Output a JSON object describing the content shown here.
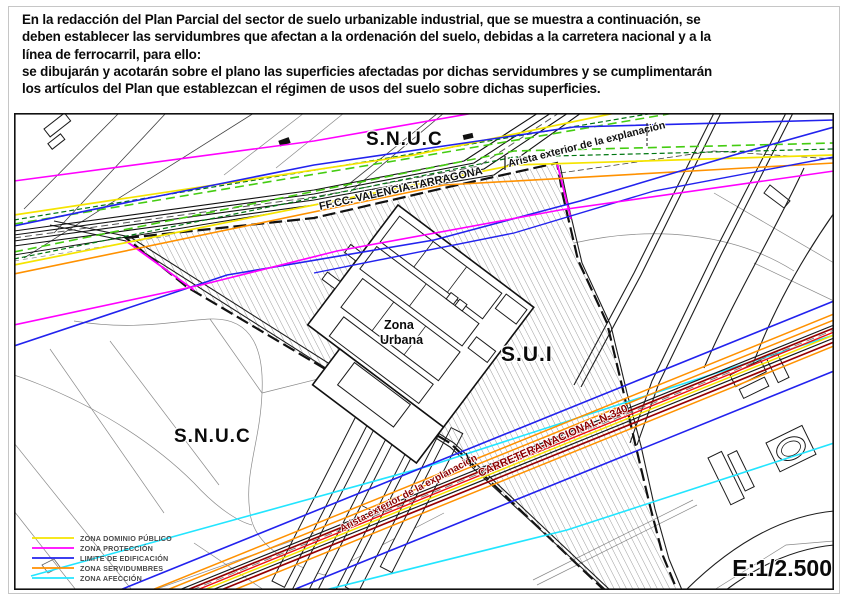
{
  "header": {
    "lines": [
      "En la redacción del Plan Parcial del sector de suelo urbanizable industrial, que se muestra a continuación, se",
      "deben establecer las servidumbres que afectan a la ordenación del suelo, debidas a la carretera nacional y a la",
      "línea de ferrocarril, para ello:",
      "se dibujarán y acotarán sobre el plano las superficies afectadas por dichas servidumbres y se cumplimentarán",
      "los artículos del Plan que establezcan el régimen de usos del suelo sobre dichas superficies."
    ]
  },
  "map": {
    "labels": {
      "snuc_top": "S.N.U.C",
      "snuc_bottom": "S.N.U.C",
      "sui": "S.U.I",
      "zona_urbana_1": "Zona",
      "zona_urbana_2": "Urbana",
      "railway_name": "FF.CC. VALENCIA-TARRAGONA",
      "railway_edge": "Arista exterior de la explanación",
      "road_edge": "Arista exterior de la explanación",
      "road_name": "CARRETERA NACIONAL N-340"
    },
    "scale": "E:1/2.500",
    "legend": {
      "items": [
        {
          "label": "ZONA DOMINIO PÚBLICO",
          "color": "#f5e400"
        },
        {
          "label": "ZONA PROTECCIÓN",
          "color": "#ff00ff"
        },
        {
          "label": "LIMITE DE EDIFICACIÓN",
          "color": "#2222ee"
        },
        {
          "label": "ZONA SERVIDUMBRES",
          "color": "#ff9100"
        },
        {
          "label": "ZONA AFECCIÓN",
          "color": "#22e5ff"
        }
      ]
    },
    "colors": {
      "proteccion": "#ff00ff",
      "edificacion": "#2222ee",
      "dominio_publico": "#f5e400",
      "servidumbres": "#ff9100",
      "afeccion": "#22e5ff",
      "explanacion_verde": "#44cc11",
      "carretera_rojo": "#ee1111",
      "carretera_granate": "#990000"
    }
  }
}
